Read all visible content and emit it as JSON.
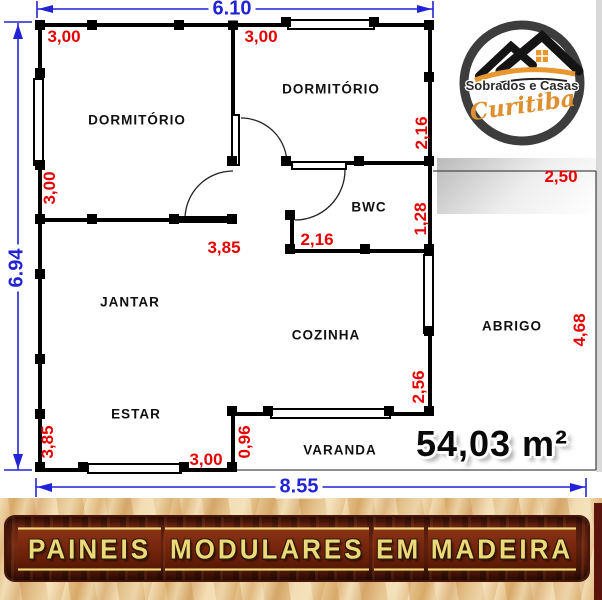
{
  "rooms": [
    "DORMITÓRIO",
    "DORMITÓRIO",
    "BWC",
    "JANTAR",
    "COZINHA",
    "ABRIGO",
    "ESTAR",
    "VARANDA"
  ],
  "area": "54,03 m²",
  "dims": {
    "blue_top": "6.10",
    "blue_left": "6.94",
    "blue_bottom": "8.55",
    "red_top_left": "3,00",
    "red_top_mid": "3,00",
    "red_dorm2_right": "2,16",
    "red_abrigo_top": "2,50",
    "red_bwc_right": "1,28",
    "red_left_upper": "3,00",
    "red_hall": "3,85",
    "red_bwc_width": "2,16",
    "red_abrigo_right": "4,68",
    "red_kitchen_right": "2,56",
    "red_left_lower": "3,85",
    "red_varanda_left": "0,96",
    "red_bottom": "3,00"
  },
  "logo": {
    "line1": "Sobrados e Casas",
    "line2": "Curitiba"
  },
  "banner": {
    "words": [
      "PAINEIS",
      "MODULARES",
      "EM",
      "MADEIRA"
    ]
  },
  "colors": {
    "dim_blue": "#2323d6",
    "dim_red": "#e60000",
    "wall": "#000000",
    "logo_orange": "#e8962e",
    "banner_text": "#ecd979",
    "banner_plank": "#6b2410",
    "sand": "#ecd2a2"
  }
}
